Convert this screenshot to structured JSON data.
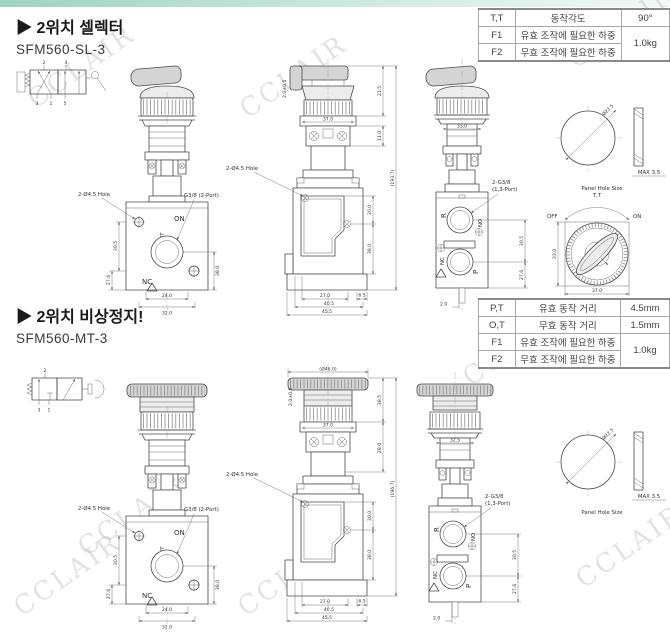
{
  "page": {
    "watermark": "CCLAIR"
  },
  "row1": {
    "title": "▶ 2위치 셀렉터",
    "model": "SFM560-SL-3",
    "sym": {
      "t1": "2",
      "t2": "4",
      "b1": "3",
      "b2": "1",
      "b3": "5"
    },
    "table": [
      {
        "c": "T,T",
        "d": "동작각도",
        "v": "90°"
      },
      {
        "c": "F1",
        "d": "유효 조작에 필요한 하중",
        "v": "1.0kg"
      },
      {
        "c": "F2",
        "d": "무효 조작에 필요한 하중"
      }
    ],
    "side": {
      "knob": "2.0±0.5",
      "d1": "21.5",
      "d2": "11.0",
      "overall": "(193.7)"
    },
    "back_w": "33.0"
  },
  "row2": {
    "title": "▶ 2위치 비상정지!",
    "model": "SFM560-MT-3",
    "sym": {
      "t1": "2",
      "b1": "3",
      "b2": "1"
    },
    "table": [
      {
        "c": "P,T",
        "d": "유효 동작 거리",
        "v": "4.5mm"
      },
      {
        "c": "O,T",
        "d": "무효 동작 거리",
        "v": "1.5mm"
      },
      {
        "c": "F1",
        "d": "유효 조작에 필요한 하중",
        "v": "1.0kg"
      },
      {
        "c": "F2",
        "d": "무효 조작에 필요한 하중"
      }
    ],
    "side": {
      "knob": "2.0±0.5",
      "head": "(Ø46.0)",
      "d1": "38.5",
      "d2": "28.0",
      "overall": "(196.7)"
    },
    "back_w": "32.5"
  },
  "front_view": {
    "hole": "2-Ø4.5 Hole",
    "port": "G3/8 (2-Port)",
    "on": "ON",
    "out": "OUT",
    "nc": "NC",
    "d_left1": "30.5",
    "d_left2": "27.6",
    "d_right": "38.0",
    "d_b1": "24.0",
    "d_b2": "32.0"
  },
  "side_view": {
    "hole": "2-Ø4.5 Hole",
    "w": "37.0",
    "r1": "30.0",
    "r2": "38.0",
    "b1": "27.0",
    "b2": "6.5",
    "b3": "40.5",
    "b4": "45.5"
  },
  "back_view": {
    "r": "R",
    "no": "NO",
    "nc": "NC",
    "p": "P",
    "port1": "2-G3/8",
    "port2": "(1,3-Port)",
    "d1": "30.5",
    "d2": "27.6",
    "b": "2.0"
  },
  "panel_hole": {
    "dia": "Ø22.5",
    "max": "MAX 3.5",
    "caption": "Panel Hole Size"
  },
  "knob_top": {
    "tt": "T,T",
    "off": "OFF",
    "on": "ON",
    "h": "33.0",
    "w": "37.0"
  }
}
